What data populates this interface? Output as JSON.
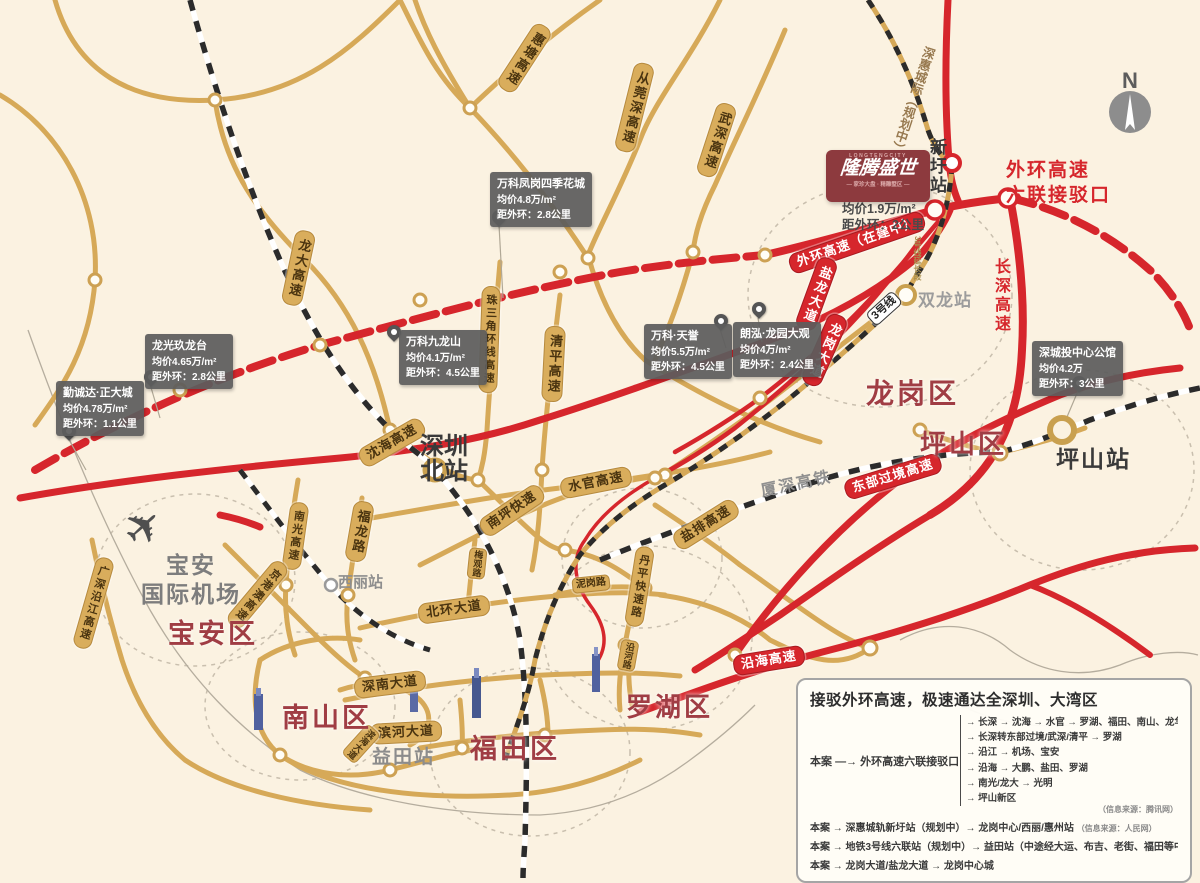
{
  "colors": {
    "gold": "#d9ad5c",
    "red": "#d6262c",
    "district_red": "#a03d44",
    "cream": "#fbf2e1",
    "callout_gray": "#5d5d5d",
    "logo_maroon": "#8d3a3e"
  },
  "compass": {
    "label": "N"
  },
  "project": {
    "logo_top": "LONGTENGCITY",
    "logo_main": "隆腾盛世",
    "logo_sub": "— 家珍大盘 · 精雕墅区 —",
    "price": "均价1.9万/m²",
    "distance": "距外环：2公里"
  },
  "districts": {
    "baoan": "宝安区",
    "nanshan": "南山区",
    "futian": "福田区",
    "luohu": "罗湖区",
    "longgang": "龙岗区",
    "pingshan": "坪山区"
  },
  "stations": {
    "shenzhen_north_l1": "深圳",
    "shenzhen_north_l2": "北站",
    "xili": "西丽站",
    "yitian": "益田站",
    "shuanglong": "双龙站",
    "xinwei": "新圩站",
    "pingshan": "坪山站"
  },
  "airport": {
    "l1": "宝安",
    "l2": "国际机场"
  },
  "roads": {
    "huitang": "惠塘高速",
    "congwanshen": "从莞深高速",
    "wushen": "武深高速",
    "longda": "龙大高速",
    "shenhai": "沈海高速",
    "zhusanjiao": "珠三角环线高速",
    "qingping": "清平高速",
    "shuiguan": "水官高速",
    "nanping": "南坪快速",
    "fulong": "福龙路",
    "nanguang": "南光高速",
    "jinggangao": "京港澳高速",
    "yanjiang": "广深沿江高速",
    "beihuan": "北环大道",
    "shennan": "深南大道",
    "binhe": "滨河大道",
    "binhai": "滨海大道",
    "meiguan": "梅观路",
    "nigang": "泥岗路",
    "danping": "丹平快速路",
    "yanhe": "沿河路",
    "yanpai": "盐排高速",
    "waihuan_build": "外环高速（在建中）",
    "yanlongdadao": "盐龙大道",
    "longgangdadao": "龙岗大道",
    "dongbu": "东部过境高速",
    "yanhai": "沿海高速",
    "changshen": "长深高速",
    "waihuan_l1": "外环高速",
    "waihuan_l2": "六联接驳口",
    "xiashen": "厦深高铁",
    "shenhui": "深惠城际（规划中）",
    "line3": "3号线",
    "line3ext": "3号线延长段"
  },
  "callouts": [
    {
      "name": "勤诚达·正大城",
      "price": "均价4.78万/m²",
      "dist": "距外环：1.1公里"
    },
    {
      "name": "龙光玖龙台",
      "price": "均价4.65万/m²",
      "dist": "距外环：2.8公里"
    },
    {
      "name": "万科凤岗四季花城",
      "price": "均价4.8万/m²",
      "dist": "距外环：2.8公里"
    },
    {
      "name": "万科九龙山",
      "price": "均价4.1万/m²",
      "dist": "距外环：4.5公里"
    },
    {
      "name": "万科·天誉",
      "price": "均价5.5万/m²",
      "dist": "距外环：4.5公里"
    },
    {
      "name": "朗泓·龙园大观",
      "price": "均价4万/m²",
      "dist": "距外环：2.4公里"
    },
    {
      "name": "深城投中心公馆",
      "price": "均价4.2万",
      "dist": "距外环：3公里"
    }
  ],
  "panel": {
    "title": "接驳外环高速，极速通达全深圳、大湾区",
    "hub_case": "本案",
    "hub_arrow": "—→",
    "hub_label": "外环高速六联接驳口",
    "branches": [
      "→ 长深 → 沈海 → 水官 → 罗湖、福田、南山、龙华",
      "→ 长深转东部过境/武深/清平 → 罗湖",
      "→ 沿江 → 机场、宝安",
      "→ 沿海 → 大鹏、盐田、罗湖",
      "→ 南光/龙大 → 光明",
      "→ 坪山新区"
    ],
    "branch_source": "（信息来源：腾讯网）",
    "rows": [
      {
        "text": "本案 → 深惠城轨新圩站（规划中）→ 龙岗中心/西丽/惠州站",
        "source": "（信息来源：人民网）"
      },
      {
        "text": "本案 → 地铁3号线六联站（规划中）→ 益田站（中途经大运、布吉、老街、福田等中转站）",
        "source": ""
      },
      {
        "text": "本案 → 龙岗大道/盐龙大道 → 龙岗中心城",
        "source": ""
      }
    ]
  }
}
